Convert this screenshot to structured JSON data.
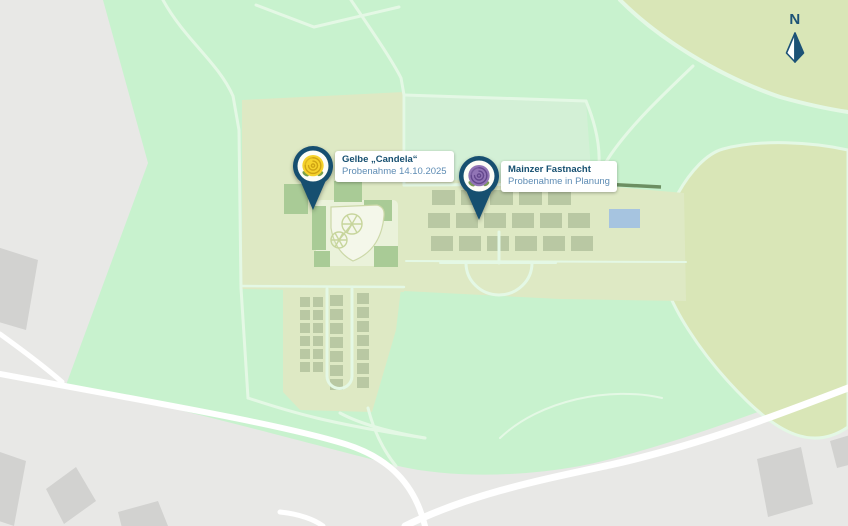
{
  "map": {
    "compass_label": "N",
    "markers": [
      {
        "title": "Gelbe „Candela“",
        "subtitle": "Probenahme 14.10.2025",
        "icon": "yellow-rose-icon",
        "flower_color": "#f6d22b"
      },
      {
        "title": "Mainzer Fastnacht",
        "subtitle": "Probenahme in Planung",
        "icon": "purple-rose-icon",
        "flower_color": "#9174b5"
      }
    ],
    "colors": {
      "pin_blue": "#164f70",
      "title_text": "#164f70",
      "subtitle_text": "#5e8cb4",
      "park_green": "#c8f2ce",
      "meadow_olive": "#d9e6b7",
      "garden_olive": "#dee9c4",
      "flower_bed": "#b9c8a3",
      "water_blue": "#a6c4e0",
      "base_gray": "#e8e8e6",
      "road_white": "#ffffff"
    }
  }
}
